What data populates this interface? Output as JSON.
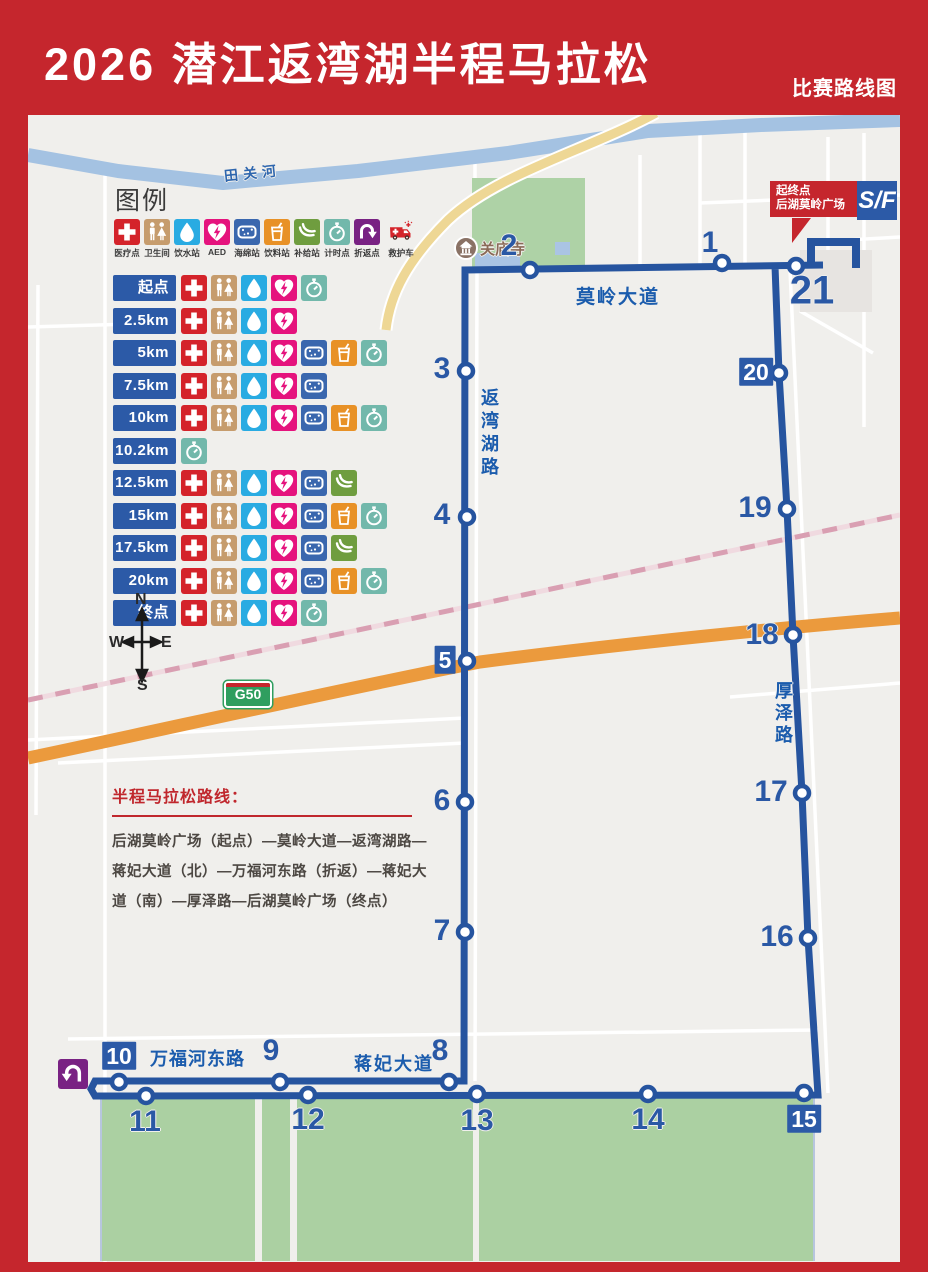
{
  "header": {
    "title": "2026  潜江返湾湖半程马拉松",
    "subtitle": "比赛路线图"
  },
  "legend": {
    "title": "图例",
    "items": [
      {
        "name": "medical",
        "label": "医疗点",
        "color": "#d4232a"
      },
      {
        "name": "toilet",
        "label": "卫生间",
        "color": "#c69c6d"
      },
      {
        "name": "water",
        "label": "饮水站",
        "color": "#29abe2"
      },
      {
        "name": "aed",
        "label": "AED",
        "color": "#e5137d"
      },
      {
        "name": "sponge",
        "label": "海绵站",
        "color": "#3a67ae"
      },
      {
        "name": "drink",
        "label": "饮料站",
        "color": "#e89126"
      },
      {
        "name": "supply",
        "label": "补给站",
        "color": "#6f9d3f"
      },
      {
        "name": "timing",
        "label": "计时点",
        "color": "#72b8ab"
      },
      {
        "name": "turnaround",
        "label": "折返点",
        "color": "#792283"
      },
      {
        "name": "ambulance",
        "label": "救护车",
        "color": "",
        "plain": true
      }
    ]
  },
  "stations": [
    {
      "label": "起点",
      "icons": [
        "medical",
        "toilet",
        "water",
        "aed",
        "timing"
      ]
    },
    {
      "label": "2.5km",
      "icons": [
        "medical",
        "toilet",
        "water",
        "aed"
      ]
    },
    {
      "label": "5km",
      "icons": [
        "medical",
        "toilet",
        "water",
        "aed",
        "sponge",
        "drink",
        "timing"
      ]
    },
    {
      "label": "7.5km",
      "icons": [
        "medical",
        "toilet",
        "water",
        "aed",
        "sponge"
      ]
    },
    {
      "label": "10km",
      "icons": [
        "medical",
        "toilet",
        "water",
        "aed",
        "sponge",
        "drink",
        "timing"
      ]
    },
    {
      "label": "10.2km",
      "icons": [
        "timing"
      ]
    },
    {
      "label": "12.5km",
      "icons": [
        "medical",
        "toilet",
        "water",
        "aed",
        "sponge",
        "supply"
      ]
    },
    {
      "label": "15km",
      "icons": [
        "medical",
        "toilet",
        "water",
        "aed",
        "sponge",
        "drink",
        "timing"
      ]
    },
    {
      "label": "17.5km",
      "icons": [
        "medical",
        "toilet",
        "water",
        "aed",
        "sponge",
        "supply"
      ]
    },
    {
      "label": "20km",
      "icons": [
        "medical",
        "toilet",
        "water",
        "aed",
        "sponge",
        "drink",
        "timing"
      ]
    },
    {
      "label": "终点",
      "icons": [
        "medical",
        "toilet",
        "water",
        "aed",
        "timing"
      ]
    }
  ],
  "compass": {
    "n": "N",
    "s": "S",
    "e": "E",
    "w": "W"
  },
  "route_info": {
    "title": "半程马拉松路线：",
    "lines": [
      "后湖莫岭广场（起点）—莫岭大道—返湾湖路—",
      "蒋妃大道（北）—万福河东路（折返）—蒋妃大",
      "道（南）—厚泽路—后湖莫岭广场（终点）"
    ]
  },
  "map_labels": {
    "river": "田关河",
    "temple": "关庙寺",
    "moling": "莫岭大道",
    "fanwanhu": "返湾湖路",
    "houze": "厚泽路",
    "wanfuhe": "万福河东路",
    "jiangfei": "蒋妃大道",
    "g50": "G50",
    "sf": "S/F",
    "callout_line1": "起终点",
    "callout_line2": "后湖莫岭广场"
  },
  "route_points": [
    {
      "n": "1",
      "cx": 694,
      "cy": 148,
      "lx": 682,
      "ly": 128,
      "boxed": false
    },
    {
      "n": "2",
      "cx": 502,
      "cy": 155,
      "lx": 481,
      "ly": 131,
      "boxed": false
    },
    {
      "n": "3",
      "cx": 438,
      "cy": 256,
      "lx": 414,
      "ly": 254,
      "boxed": false
    },
    {
      "n": "4",
      "cx": 439,
      "cy": 402,
      "lx": 414,
      "ly": 400,
      "boxed": false
    },
    {
      "n": "5",
      "cx": 439,
      "cy": 546,
      "lx": 417,
      "ly": 545,
      "boxed": true
    },
    {
      "n": "6",
      "cx": 437,
      "cy": 687,
      "lx": 414,
      "ly": 686,
      "boxed": false
    },
    {
      "n": "7",
      "cx": 437,
      "cy": 817,
      "lx": 414,
      "ly": 816,
      "boxed": false
    },
    {
      "n": "8",
      "cx": 421,
      "cy": 967,
      "lx": 412,
      "ly": 936,
      "boxed": false
    },
    {
      "n": "9",
      "cx": 252,
      "cy": 967,
      "lx": 243,
      "ly": 936,
      "boxed": false
    },
    {
      "n": "10",
      "cx": 91,
      "cy": 967,
      "lx": 91,
      "ly": 941,
      "boxed": true
    },
    {
      "n": "11",
      "cx": 118,
      "cy": 981,
      "lx": 117,
      "ly": 1007,
      "boxed": false
    },
    {
      "n": "12",
      "cx": 280,
      "cy": 980,
      "lx": 280,
      "ly": 1005,
      "boxed": false
    },
    {
      "n": "13",
      "cx": 449,
      "cy": 979,
      "lx": 449,
      "ly": 1006,
      "boxed": false
    },
    {
      "n": "14",
      "cx": 620,
      "cy": 979,
      "lx": 620,
      "ly": 1005,
      "boxed": false
    },
    {
      "n": "15",
      "cx": 776,
      "cy": 978,
      "lx": 776,
      "ly": 1004,
      "boxed": true
    },
    {
      "n": "16",
      "cx": 780,
      "cy": 823,
      "lx": 749,
      "ly": 822,
      "boxed": false
    },
    {
      "n": "17",
      "cx": 774,
      "cy": 678,
      "lx": 743,
      "ly": 677,
      "boxed": false
    },
    {
      "n": "18",
      "cx": 765,
      "cy": 520,
      "lx": 734,
      "ly": 520,
      "boxed": false
    },
    {
      "n": "19",
      "cx": 759,
      "cy": 394,
      "lx": 727,
      "ly": 393,
      "boxed": false
    },
    {
      "n": "20",
      "cx": 751,
      "cy": 258,
      "lx": 728,
      "ly": 257,
      "boxed": true
    },
    {
      "n": "21",
      "cx": 768,
      "cy": 151,
      "lx": 784,
      "ly": 176,
      "boxed": false,
      "big": true
    }
  ],
  "colors": {
    "route": "#26549f",
    "header_red": "#c5262d",
    "label_box_blue": "#2c5aa7"
  }
}
